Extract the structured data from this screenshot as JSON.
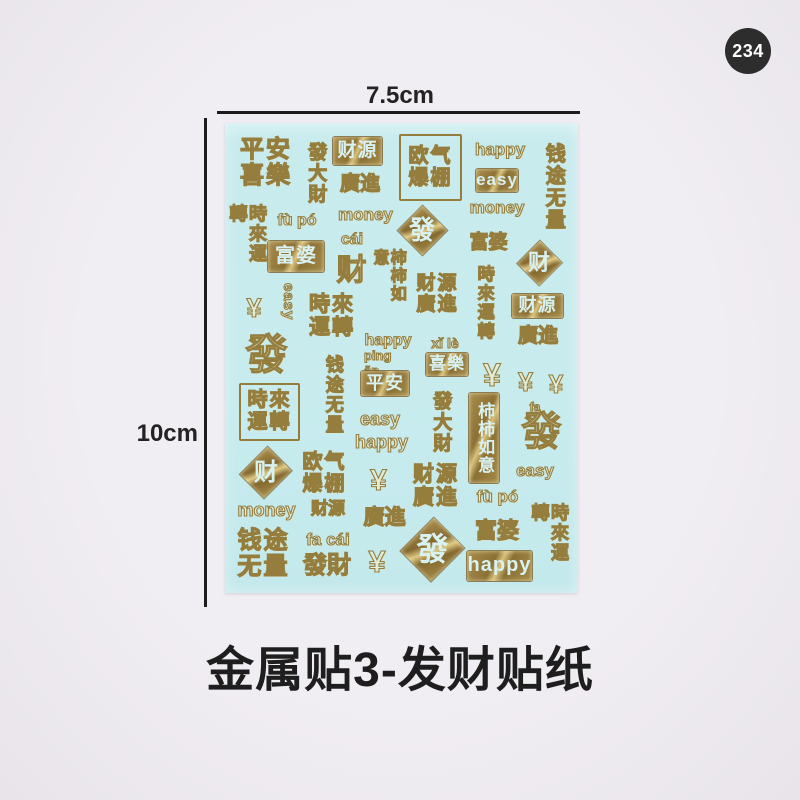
{
  "badge": {
    "number": "234"
  },
  "dimensions": {
    "width_label": "7.5cm",
    "height_label": "10cm"
  },
  "caption": {
    "text": "金属贴3-发财贴纸"
  },
  "colors": {
    "background": "#efecf1",
    "sheet": "#c8ecee",
    "gold": "#97803f",
    "gold_highlight": "#d9c27c",
    "knockout_text": "#d8f1f1",
    "badge_bg": "#2d2d2d",
    "badge_text": "#ffffff",
    "annotation_text": "#232323"
  },
  "stickers": [
    {
      "name": "ping-an-xi-le-grid",
      "text": "平安\n喜樂",
      "cls": "outline grid",
      "x": 13,
      "y": 15,
      "w": 56,
      "h": 50,
      "fs": 24
    },
    {
      "name": "fa-da-cai-vert",
      "text": "發大財",
      "cls": "outline vert",
      "x": 78,
      "y": 13,
      "w": 24,
      "h": 75,
      "fs": 19
    },
    {
      "name": "cai-yuan-box",
      "text": "财源",
      "cls": "box",
      "x": 108,
      "y": 14,
      "w": 49,
      "h": 28,
      "fs": 19
    },
    {
      "name": "guang-jin",
      "text": "廣進",
      "cls": "outline",
      "x": 111,
      "y": 50,
      "w": 48,
      "h": 24,
      "fs": 20
    },
    {
      "name": "ou-qi-bao-peng-obox",
      "text": "欧气\n爆棚",
      "cls": "outline obox grid",
      "x": 174,
      "y": 11,
      "w": 59,
      "h": 63,
      "fs": 20
    },
    {
      "name": "happy-1",
      "text": "happy",
      "cls": "outline",
      "x": 247,
      "y": 17,
      "w": 56,
      "h": 20,
      "fs": 17
    },
    {
      "name": "easy-box",
      "text": "easy",
      "cls": "box",
      "x": 251,
      "y": 46,
      "w": 42,
      "h": 23,
      "fs": 17
    },
    {
      "name": "money-1",
      "text": "money",
      "cls": "outline",
      "x": 242,
      "y": 76,
      "w": 60,
      "h": 18,
      "fs": 17
    },
    {
      "name": "qian-tu-wu-liang-vert-1",
      "text": "钱途无量",
      "cls": "outline vert",
      "x": 315,
      "y": 14,
      "w": 25,
      "h": 100,
      "fs": 20
    },
    {
      "name": "shi-lai-yun-zhuan-vert-1",
      "text": "時來運轉",
      "cls": "outline vert",
      "x": 10,
      "y": 81,
      "w": 23,
      "h": 75,
      "fs": 18
    },
    {
      "name": "fu-po-pinyin-1",
      "text": "fù pó",
      "cls": "outline",
      "x": 45,
      "y": 88,
      "w": 54,
      "h": 20,
      "fs": 16
    },
    {
      "name": "fu-po-box",
      "text": "富婆",
      "cls": "box",
      "x": 43,
      "y": 118,
      "w": 56,
      "h": 31,
      "fs": 20
    },
    {
      "name": "money-2",
      "text": "money",
      "cls": "outline",
      "x": 110,
      "y": 83,
      "w": 61,
      "h": 18,
      "fs": 17
    },
    {
      "name": "cai-pinyin",
      "text": "cái",
      "cls": "outline",
      "x": 113,
      "y": 108,
      "w": 28,
      "h": 17,
      "fs": 16
    },
    {
      "name": "cai-large",
      "text": "财",
      "cls": "outline",
      "x": 109,
      "y": 132,
      "w": 35,
      "h": 33,
      "fs": 30
    },
    {
      "name": "fa-diamond-1",
      "text": "發",
      "cls": "diamond",
      "x": 172,
      "y": 82,
      "w": 50,
      "h": 50,
      "fs": 26
    },
    {
      "name": "shi-shi-ru-yi-vert",
      "text": "柿柿如意",
      "cls": "outline vert",
      "x": 152,
      "y": 126,
      "w": 21,
      "h": 70,
      "fs": 16
    },
    {
      "name": "cai-yuan-guang-jin-grid-1",
      "text": "财源\n廣進",
      "cls": "outline grid",
      "x": 191,
      "y": 151,
      "w": 43,
      "h": 42,
      "fs": 19
    },
    {
      "name": "fu-po-script-1",
      "text": "富婆",
      "cls": "outline",
      "x": 241,
      "y": 109,
      "w": 45,
      "h": 23,
      "fs": 19
    },
    {
      "name": "shi-lai-yun-zhuan-vert-2",
      "text": "時來運轉",
      "cls": "outline vert",
      "x": 247,
      "y": 141,
      "w": 23,
      "h": 77,
      "fs": 17
    },
    {
      "name": "cai-diamond-1",
      "text": "财",
      "cls": "diamond",
      "x": 292,
      "y": 117,
      "w": 44,
      "h": 46,
      "fs": 22
    },
    {
      "name": "cai-yuan-box-2",
      "text": "财源",
      "cls": "box",
      "x": 287,
      "y": 171,
      "w": 51,
      "h": 24,
      "fs": 18
    },
    {
      "name": "guang-jin-2",
      "text": "廣進",
      "cls": "outline",
      "x": 284,
      "y": 203,
      "w": 58,
      "h": 22,
      "fs": 20
    },
    {
      "name": "yen-1",
      "text": "¥",
      "cls": "outline",
      "x": 14,
      "y": 172,
      "w": 30,
      "h": 28,
      "fs": 27
    },
    {
      "name": "easy-vert",
      "text": "easy",
      "cls": "outline vlat",
      "x": 54,
      "y": 150,
      "w": 18,
      "h": 58,
      "fs": 15
    },
    {
      "name": "shi-lai-yun-zhuan-grid",
      "text": "時來\n運轉",
      "cls": "outline grid",
      "x": 81,
      "y": 171,
      "w": 52,
      "h": 46,
      "fs": 21
    },
    {
      "name": "fa-large-script",
      "text": "發",
      "cls": "outline",
      "x": 17,
      "y": 207,
      "w": 49,
      "h": 50,
      "fs": 42
    },
    {
      "name": "happy-2",
      "text": "happy",
      "cls": "outline",
      "x": 137,
      "y": 208,
      "w": 52,
      "h": 20,
      "fs": 16
    },
    {
      "name": "xi-le-pinyin",
      "text": "xǐ lè",
      "cls": "outline",
      "x": 201,
      "y": 213,
      "w": 38,
      "h": 16,
      "fs": 14
    },
    {
      "name": "xi-le-box",
      "text": "喜樂",
      "cls": "box",
      "x": 201,
      "y": 230,
      "w": 42,
      "h": 23,
      "fs": 17
    },
    {
      "name": "ping-an-pinyin",
      "text": "ping ān",
      "cls": "outline",
      "x": 139,
      "y": 233,
      "w": 40,
      "h": 15,
      "fs": 13
    },
    {
      "name": "ping-an-box",
      "text": "平安",
      "cls": "box",
      "x": 136,
      "y": 248,
      "w": 48,
      "h": 25,
      "fs": 18
    },
    {
      "name": "qian-tu-wu-liang-vert-2",
      "text": "钱途无量",
      "cls": "outline vert",
      "x": 97,
      "y": 227,
      "w": 22,
      "h": 90,
      "fs": 18
    },
    {
      "name": "easy-2",
      "text": "easy",
      "cls": "outline",
      "x": 131,
      "y": 285,
      "w": 48,
      "h": 23,
      "fs": 18
    },
    {
      "name": "happy-3",
      "text": "happy",
      "cls": "outline",
      "x": 129,
      "y": 308,
      "w": 55,
      "h": 23,
      "fs": 18
    },
    {
      "name": "fa-da-cai-vert-2",
      "text": "發大財",
      "cls": "outline vert",
      "x": 202,
      "y": 265,
      "w": 26,
      "h": 68,
      "fs": 19
    },
    {
      "name": "shi-shi-ru-yi-box-vert",
      "text": "柿柿如意",
      "cls": "box vert",
      "x": 244,
      "y": 270,
      "w": 30,
      "h": 90,
      "fs": 17
    },
    {
      "name": "fa-pinyin",
      "text": "fa",
      "cls": "outline",
      "x": 301,
      "y": 278,
      "w": 18,
      "h": 13,
      "fs": 12
    },
    {
      "name": "fa-script-2",
      "text": "發",
      "cls": "outline",
      "x": 284,
      "y": 287,
      "w": 65,
      "h": 45,
      "fs": 40
    },
    {
      "name": "easy-3",
      "text": "easy",
      "cls": "outline",
      "x": 286,
      "y": 337,
      "w": 48,
      "h": 22,
      "fs": 17
    },
    {
      "name": "yen-large",
      "text": "¥",
      "cls": "outline",
      "x": 251,
      "y": 235,
      "w": 32,
      "h": 35,
      "fs": 32
    },
    {
      "name": "yen-2",
      "text": "¥",
      "cls": "outline",
      "x": 286,
      "y": 245,
      "w": 29,
      "h": 29,
      "fs": 27
    },
    {
      "name": "yen-3",
      "text": "¥",
      "cls": "outline",
      "x": 317,
      "y": 247,
      "w": 28,
      "h": 28,
      "fs": 26
    },
    {
      "name": "shi-lai-yun-zhuan-obox",
      "text": "時來\n運轉",
      "cls": "outline obox grid",
      "x": 14,
      "y": 260,
      "w": 57,
      "h": 54,
      "fs": 20
    },
    {
      "name": "cai-diamond-2",
      "text": "财",
      "cls": "diamond",
      "x": 17,
      "y": 322,
      "w": 48,
      "h": 55,
      "fs": 24
    },
    {
      "name": "ou-qi-bao-peng-grid-2",
      "text": "欧气\n爆棚",
      "cls": "outline grid",
      "x": 74,
      "y": 322,
      "w": 51,
      "h": 58,
      "fs": 20
    },
    {
      "name": "yen-4",
      "text": "¥",
      "cls": "outline",
      "x": 139,
      "y": 340,
      "w": 29,
      "h": 36,
      "fs": 30
    },
    {
      "name": "cai-yuan-guang-jin-grid-2",
      "text": "财源\n廣進",
      "cls": "outline grid",
      "x": 184,
      "y": 340,
      "w": 54,
      "h": 47,
      "fs": 21
    },
    {
      "name": "fu-po-pinyin-2",
      "text": "fù pó",
      "cls": "outline",
      "x": 242,
      "y": 363,
      "w": 61,
      "h": 23,
      "fs": 17
    },
    {
      "name": "money-3",
      "text": "money",
      "cls": "outline",
      "x": 11,
      "y": 377,
      "w": 61,
      "h": 22,
      "fs": 18
    },
    {
      "name": "cai-yuan-plain",
      "text": "财源",
      "cls": "outline",
      "x": 81,
      "y": 377,
      "w": 44,
      "h": 19,
      "fs": 17
    },
    {
      "name": "guang-jin-3",
      "text": "廣進",
      "cls": "outline",
      "x": 134,
      "y": 383,
      "w": 51,
      "h": 25,
      "fs": 21
    },
    {
      "name": "fu-po-script-2",
      "text": "富婆",
      "cls": "outline",
      "x": 247,
      "y": 393,
      "w": 50,
      "h": 30,
      "fs": 22
    },
    {
      "name": "qian-tu-wu-liang-grid",
      "text": "钱途\n无量",
      "cls": "outline grid",
      "x": 9,
      "y": 405,
      "w": 59,
      "h": 52,
      "fs": 24
    },
    {
      "name": "fa-cai-pinyin",
      "text": "fa cái",
      "cls": "outline",
      "x": 74,
      "y": 407,
      "w": 58,
      "h": 21,
      "fs": 17
    },
    {
      "name": "fa-cai",
      "text": "發財",
      "cls": "outline",
      "x": 69,
      "y": 430,
      "w": 66,
      "h": 26,
      "fs": 24
    },
    {
      "name": "yen-5",
      "text": "¥",
      "cls": "outline",
      "x": 137,
      "y": 420,
      "w": 30,
      "h": 37,
      "fs": 31
    },
    {
      "name": "fa-diamond-2",
      "text": "發",
      "cls": "diamond",
      "x": 177,
      "y": 393,
      "w": 61,
      "h": 67,
      "fs": 32
    },
    {
      "name": "happy-box",
      "text": "happy",
      "cls": "box",
      "x": 242,
      "y": 428,
      "w": 65,
      "h": 30,
      "fs": 20
    },
    {
      "name": "shi-lai-yun-zhuan-vert-3",
      "text": "時來運轉",
      "cls": "outline vert",
      "x": 309,
      "y": 380,
      "w": 29,
      "h": 78,
      "fs": 18
    }
  ]
}
